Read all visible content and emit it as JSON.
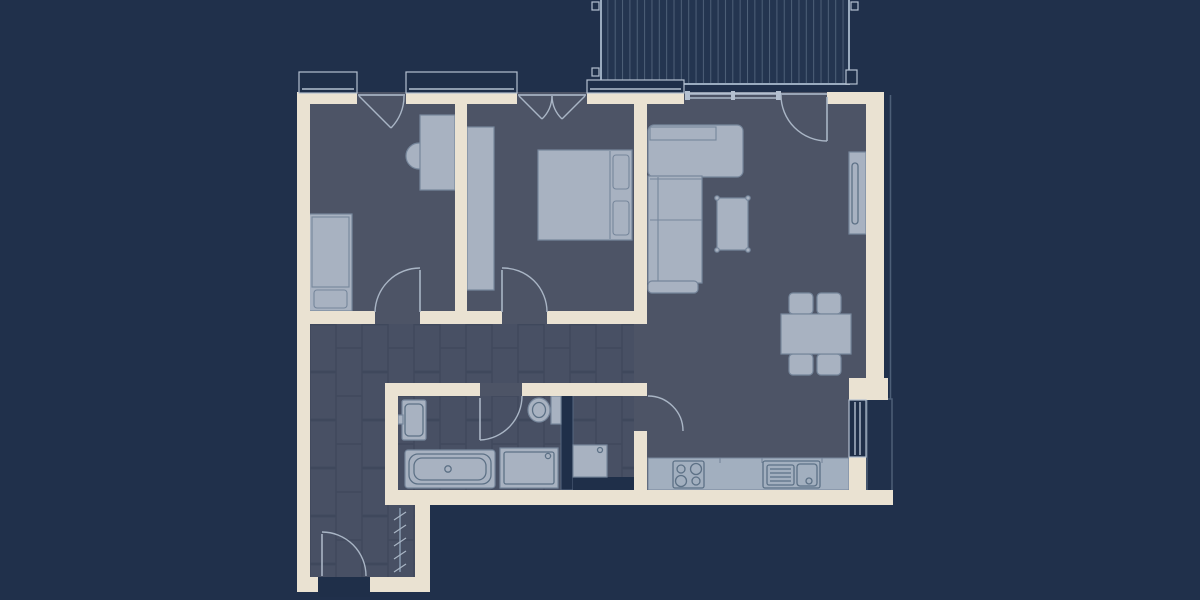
{
  "colors": {
    "background": "#20304b",
    "wall": "#eae2d2",
    "room_fill": "#4d5466",
    "tile_fill": "#485064",
    "tile_line": "#3f485c",
    "deck_fill": "#243550",
    "deck_line": "#4e6078",
    "deck_border": "#9aabbf",
    "furniture_fill": "#a8b2c1",
    "furniture_stroke": "#76869b",
    "fixture_stroke": "#5d7186",
    "counter_fill": "#a2afbf",
    "door_arc": "#a9b5c5",
    "window_frame": "#b4c0d0",
    "dark_fill": "#1f2f49",
    "shaft_stroke": "#54667e",
    "rail_line": "#4d5f78"
  },
  "plan": {
    "type": "apartment-floor-plan",
    "rooms": [
      {
        "name": "bedroom-1",
        "furniture": [
          "single-bed",
          "desk",
          "desk-chair"
        ]
      },
      {
        "name": "bedroom-2",
        "furniture": [
          "double-bed",
          "pillows",
          "wardrobe"
        ]
      },
      {
        "name": "living-dining-kitchen",
        "furniture": [
          "corner-sofa",
          "coffee-table",
          "tv-console",
          "dining-table",
          "four-chairs",
          "kitchen-counter",
          "hob",
          "sink"
        ]
      },
      {
        "name": "bathroom",
        "furniture": [
          "washbasin",
          "toilet",
          "bathtub",
          "shower"
        ]
      },
      {
        "name": "utility-room",
        "furniture": [
          "washing-machine",
          "counter"
        ]
      },
      {
        "name": "hallway",
        "furniture": [
          "coat-rack"
        ]
      },
      {
        "name": "entrance-vestibule",
        "furniture": []
      },
      {
        "name": "balcony",
        "furniture": []
      }
    ],
    "doors": [
      "entrance-door",
      "bedroom-1-door",
      "bedroom-2-door",
      "bathroom-door",
      "utility-door",
      "balcony-door"
    ],
    "windows": [
      "fixed-window-a",
      "fixed-window-b",
      "fixed-window-c",
      "casement-window-single",
      "casement-window-double",
      "sliding-balcony-glazing",
      "kitchen-window"
    ]
  }
}
